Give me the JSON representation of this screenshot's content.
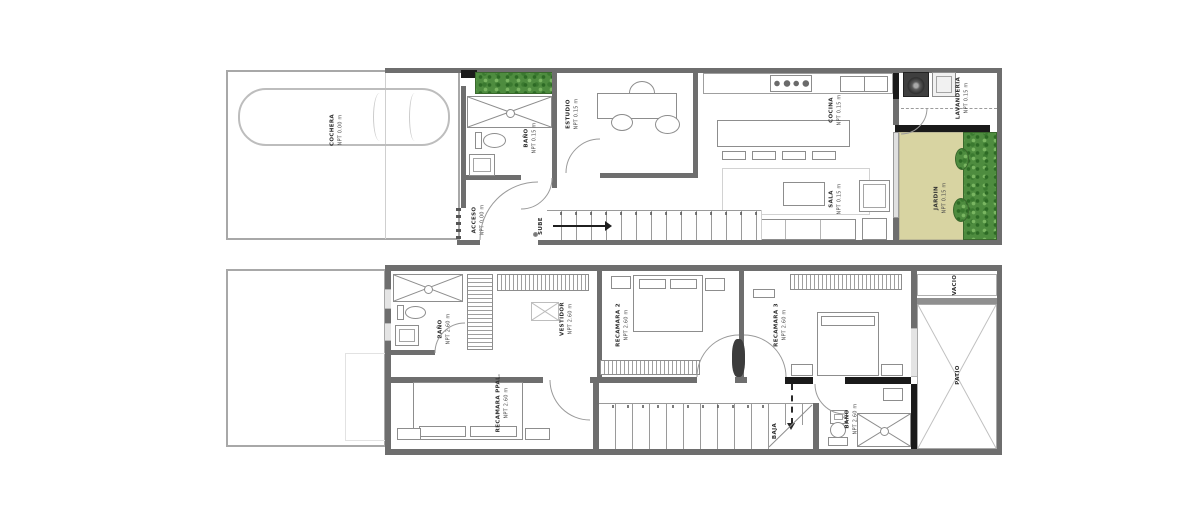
{
  "colors": {
    "wall_gray": "#6e6e6e",
    "wall_black": "#1a1a1a",
    "grass_green": "#d8d4a2",
    "foliage_green": "#4e8c3f",
    "line_gray": "#9a9a9a"
  },
  "floor1": {
    "stairs_label": "SUBE",
    "rooms": {
      "cochera": {
        "name": "COCHERA",
        "level": "NPT 0.00 m"
      },
      "acceso": {
        "name": "ACCESO",
        "level": "NPT 0.00 m"
      },
      "bano": {
        "name": "BAÑO",
        "level": "NPT 0.15 m"
      },
      "estudio": {
        "name": "ESTUDIO",
        "level": "NPT 0.15 m"
      },
      "cocina": {
        "name": "COCINA",
        "level": "NPT 0.15 m"
      },
      "sala": {
        "name": "SALA",
        "level": "NPT 0.15 m"
      },
      "lavanderia": {
        "name": "LAVANDERIA",
        "level": "NPT 0.15 m"
      },
      "jardin": {
        "name": "JARDIN",
        "level": "NPT 0.15 m"
      }
    }
  },
  "floor2": {
    "stairs_label": "BAJA",
    "rooms": {
      "bano": {
        "name": "BAÑO",
        "level": "NPT 2.60 m"
      },
      "vestidor": {
        "name": "VESTIDOR",
        "level": "NPT 2.60 m"
      },
      "recamara_ppal": {
        "name": "RECAMARA PPAL.",
        "level": "NPT 2.60 m"
      },
      "recamara2": {
        "name": "RECAMARA 2",
        "level": "NPT 2.60 m"
      },
      "recamara3": {
        "name": "RECAMARA 3",
        "level": "NPT 2.60 m"
      },
      "bano2": {
        "name": "BAÑO",
        "level": "NPT 2.60 m"
      },
      "patio": {
        "name": "PATIO"
      },
      "vacio": {
        "name": "VACIO"
      }
    }
  }
}
